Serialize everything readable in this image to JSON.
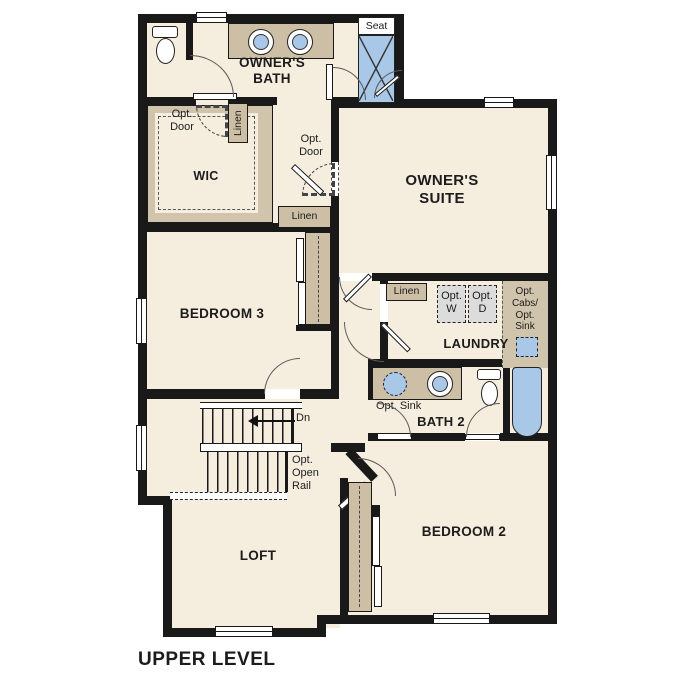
{
  "plan": {
    "title": "UPPER LEVEL",
    "level": "upper",
    "colors": {
      "wall": "#191919",
      "floor": "#f5edde",
      "cabinet_tan": "#ccbfa5",
      "fixture_blue": "#a9c7e6",
      "appliance_gray": "#dcdcdc",
      "background": "#ffffff"
    },
    "rooms": {
      "owners_bath": "OWNER'S\nBATH",
      "owners_suite": "OWNER'S\nSUITE",
      "wic": "WIC",
      "bedroom3": "BEDROOM 3",
      "laundry": "LAUNDRY",
      "bath2": "BATH 2",
      "bedroom2": "BEDROOM 2",
      "loft": "LOFT"
    },
    "labels": {
      "seat": "Seat",
      "linen": "Linen",
      "opt_door": "Opt.\nDoor",
      "opt_w": "Opt.\nW",
      "opt_d": "Opt.\nD",
      "opt_cabs_sink": "Opt.\nCabs/\nOpt.\nSink",
      "opt_sink": "Opt. Sink",
      "dn": "Dn",
      "opt_open_rail": "Opt.\nOpen\nRail"
    },
    "fixtures": [
      "toilet-owners-bath",
      "double-vanity-sinks-owners-bath",
      "shower-with-seat",
      "optional-washer",
      "optional-dryer",
      "optional-laundry-sink",
      "bath2-vanity-with-optional-sink",
      "toilet-bath2",
      "bathtub",
      "switchback-stairs-down"
    ]
  }
}
